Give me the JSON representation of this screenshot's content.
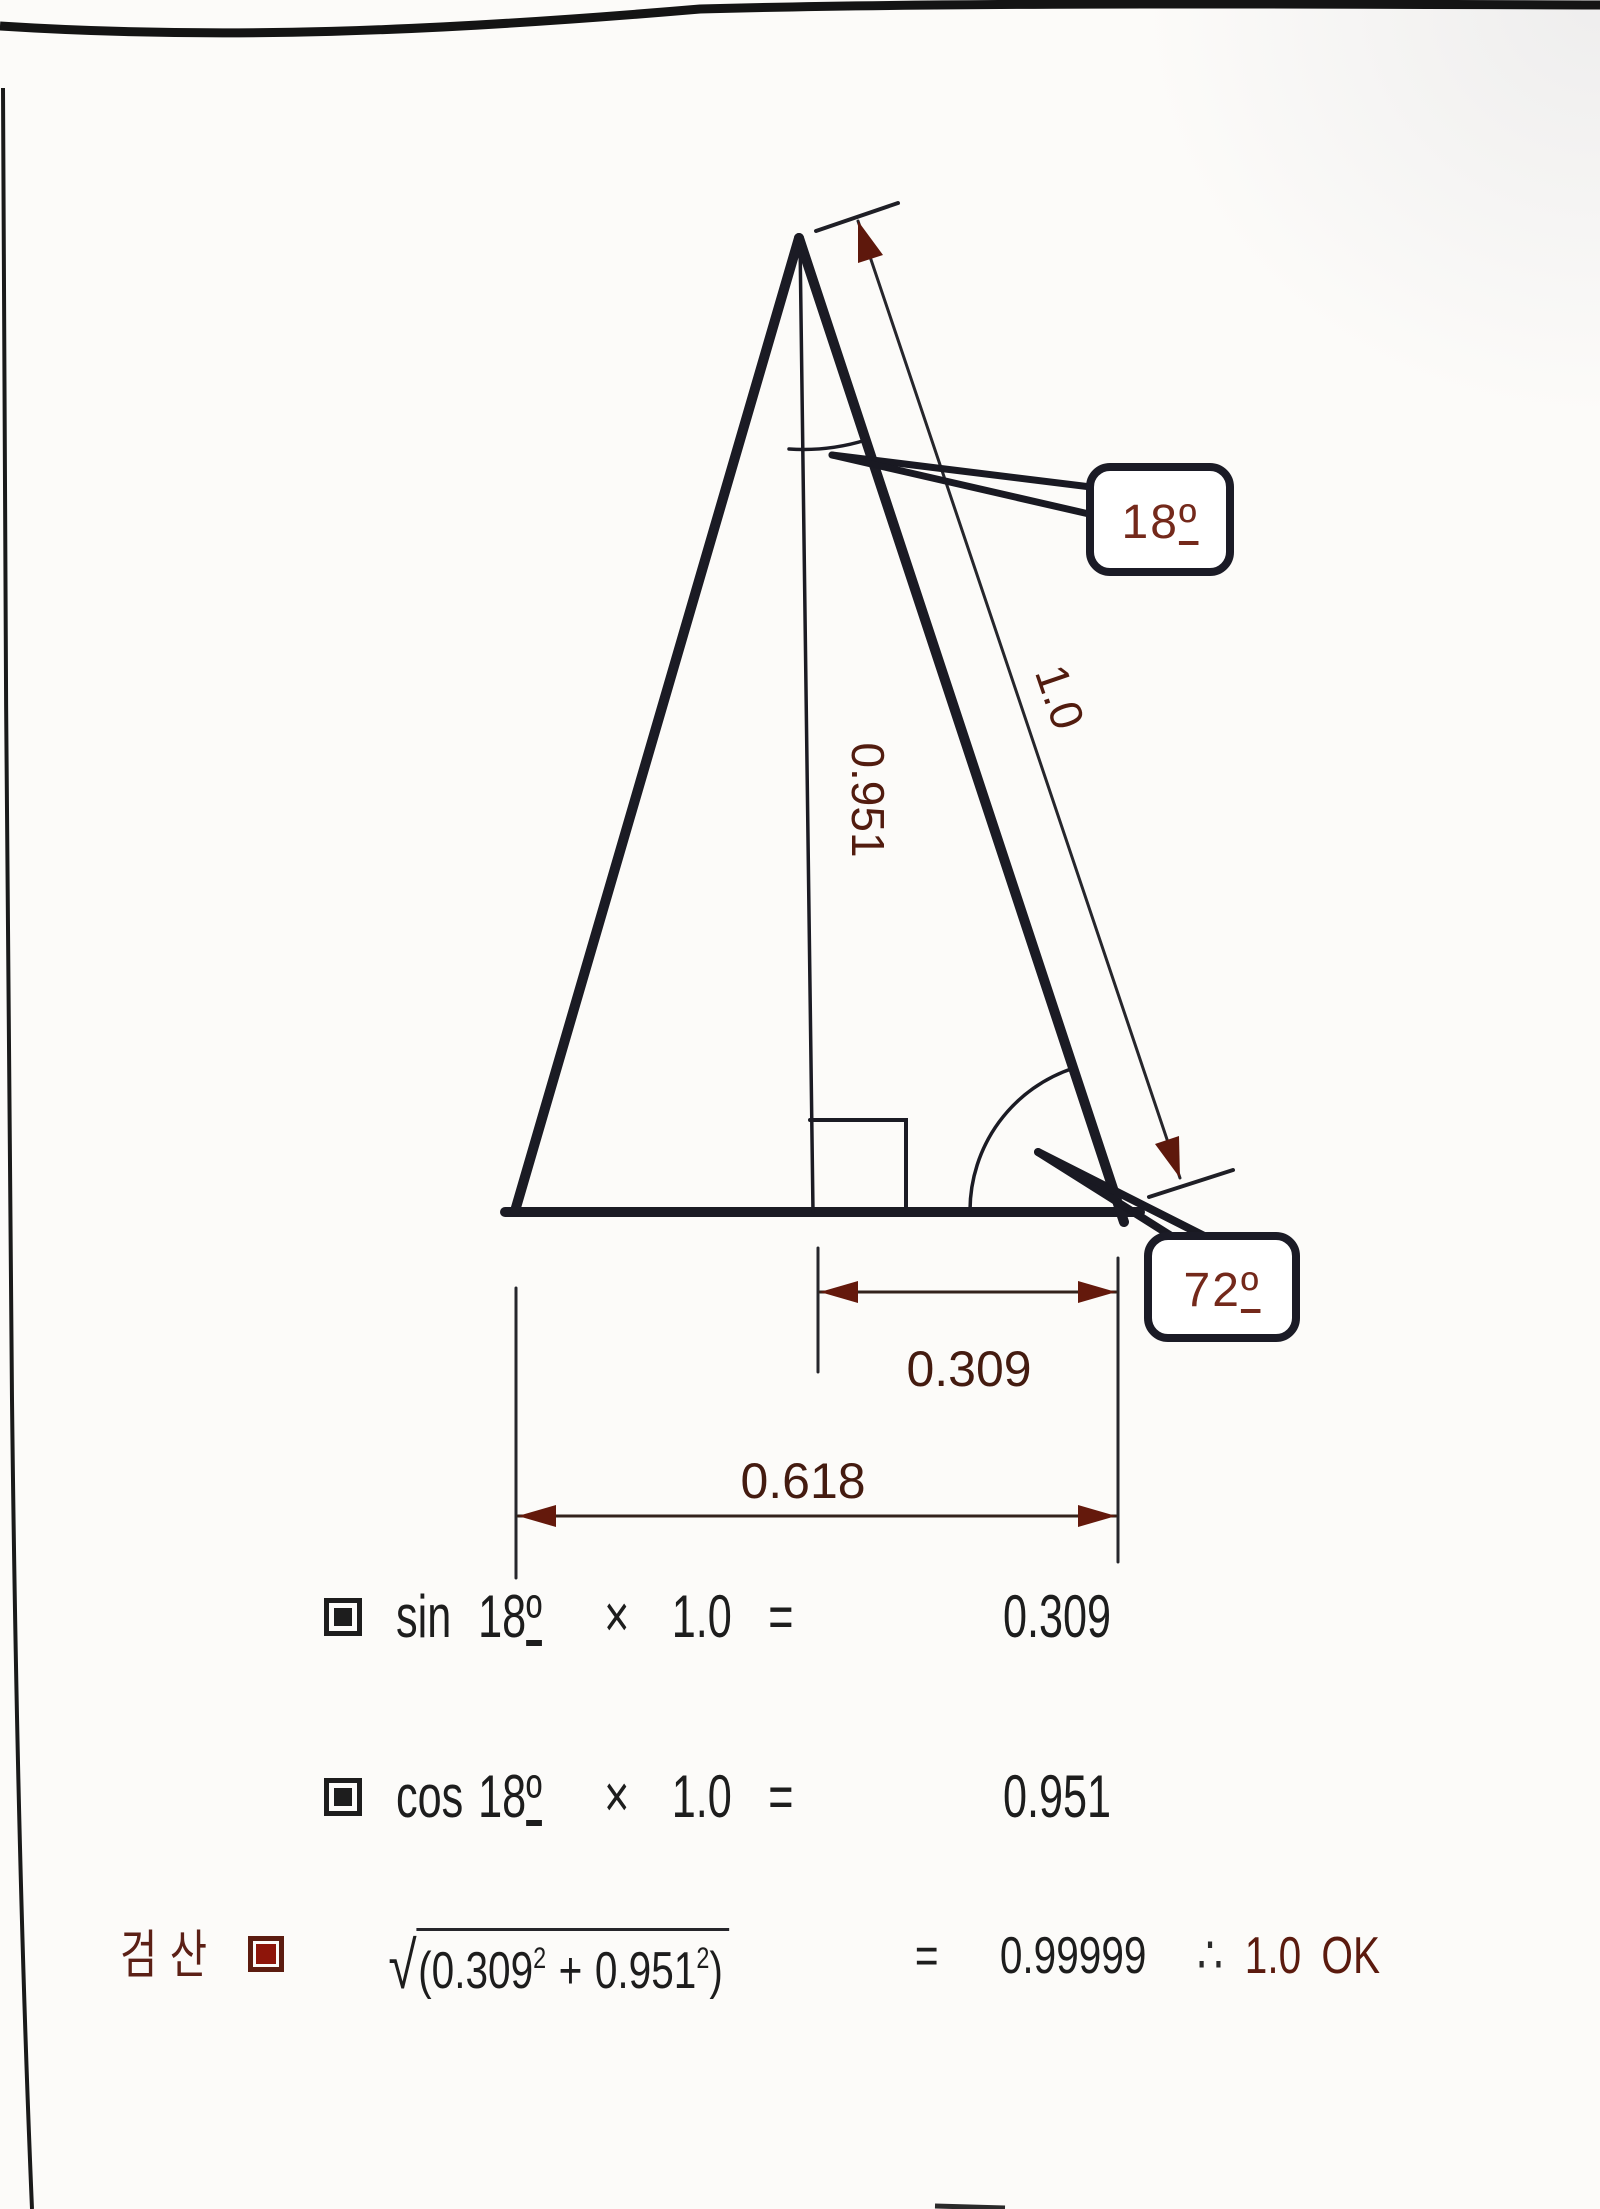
{
  "colors": {
    "ink": "#1b1b24",
    "arrow_maroon": "#64190c",
    "callout_text": "#74291b",
    "dimension_text": "#441b10",
    "check_bullet_fill": "#8e150a",
    "korean_label": "#5c2016"
  },
  "diagram": {
    "apex_angle": {
      "value": "18",
      "ordinal": "º"
    },
    "base_angle": {
      "value": "72",
      "ordinal": "º"
    },
    "hypotenuse_label": "1.0",
    "height_label": "0.951",
    "half_base_label": "0.309",
    "base_label": "0.618"
  },
  "formulas": {
    "sin_line": {
      "func": "sin",
      "angle": "18",
      "ordinal": "º",
      "times": "×",
      "factor": "1.0",
      "equals": "=",
      "result": "0.309"
    },
    "cos_line": {
      "func": "cos",
      "angle": "18",
      "ordinal": "º",
      "times": "×",
      "factor": "1.0",
      "equals": "=",
      "result": "0.951"
    },
    "check_line": {
      "label": "검산",
      "radical": "√",
      "open": "(",
      "term1": "0.309",
      "sup1": "2",
      "plus": "+",
      "term2": "0.951",
      "sup2": "2",
      "close": ")",
      "equals": "=",
      "result": "0.99999",
      "therefore": "∴",
      "final_value": "1.0",
      "final_ok": "OK"
    }
  }
}
